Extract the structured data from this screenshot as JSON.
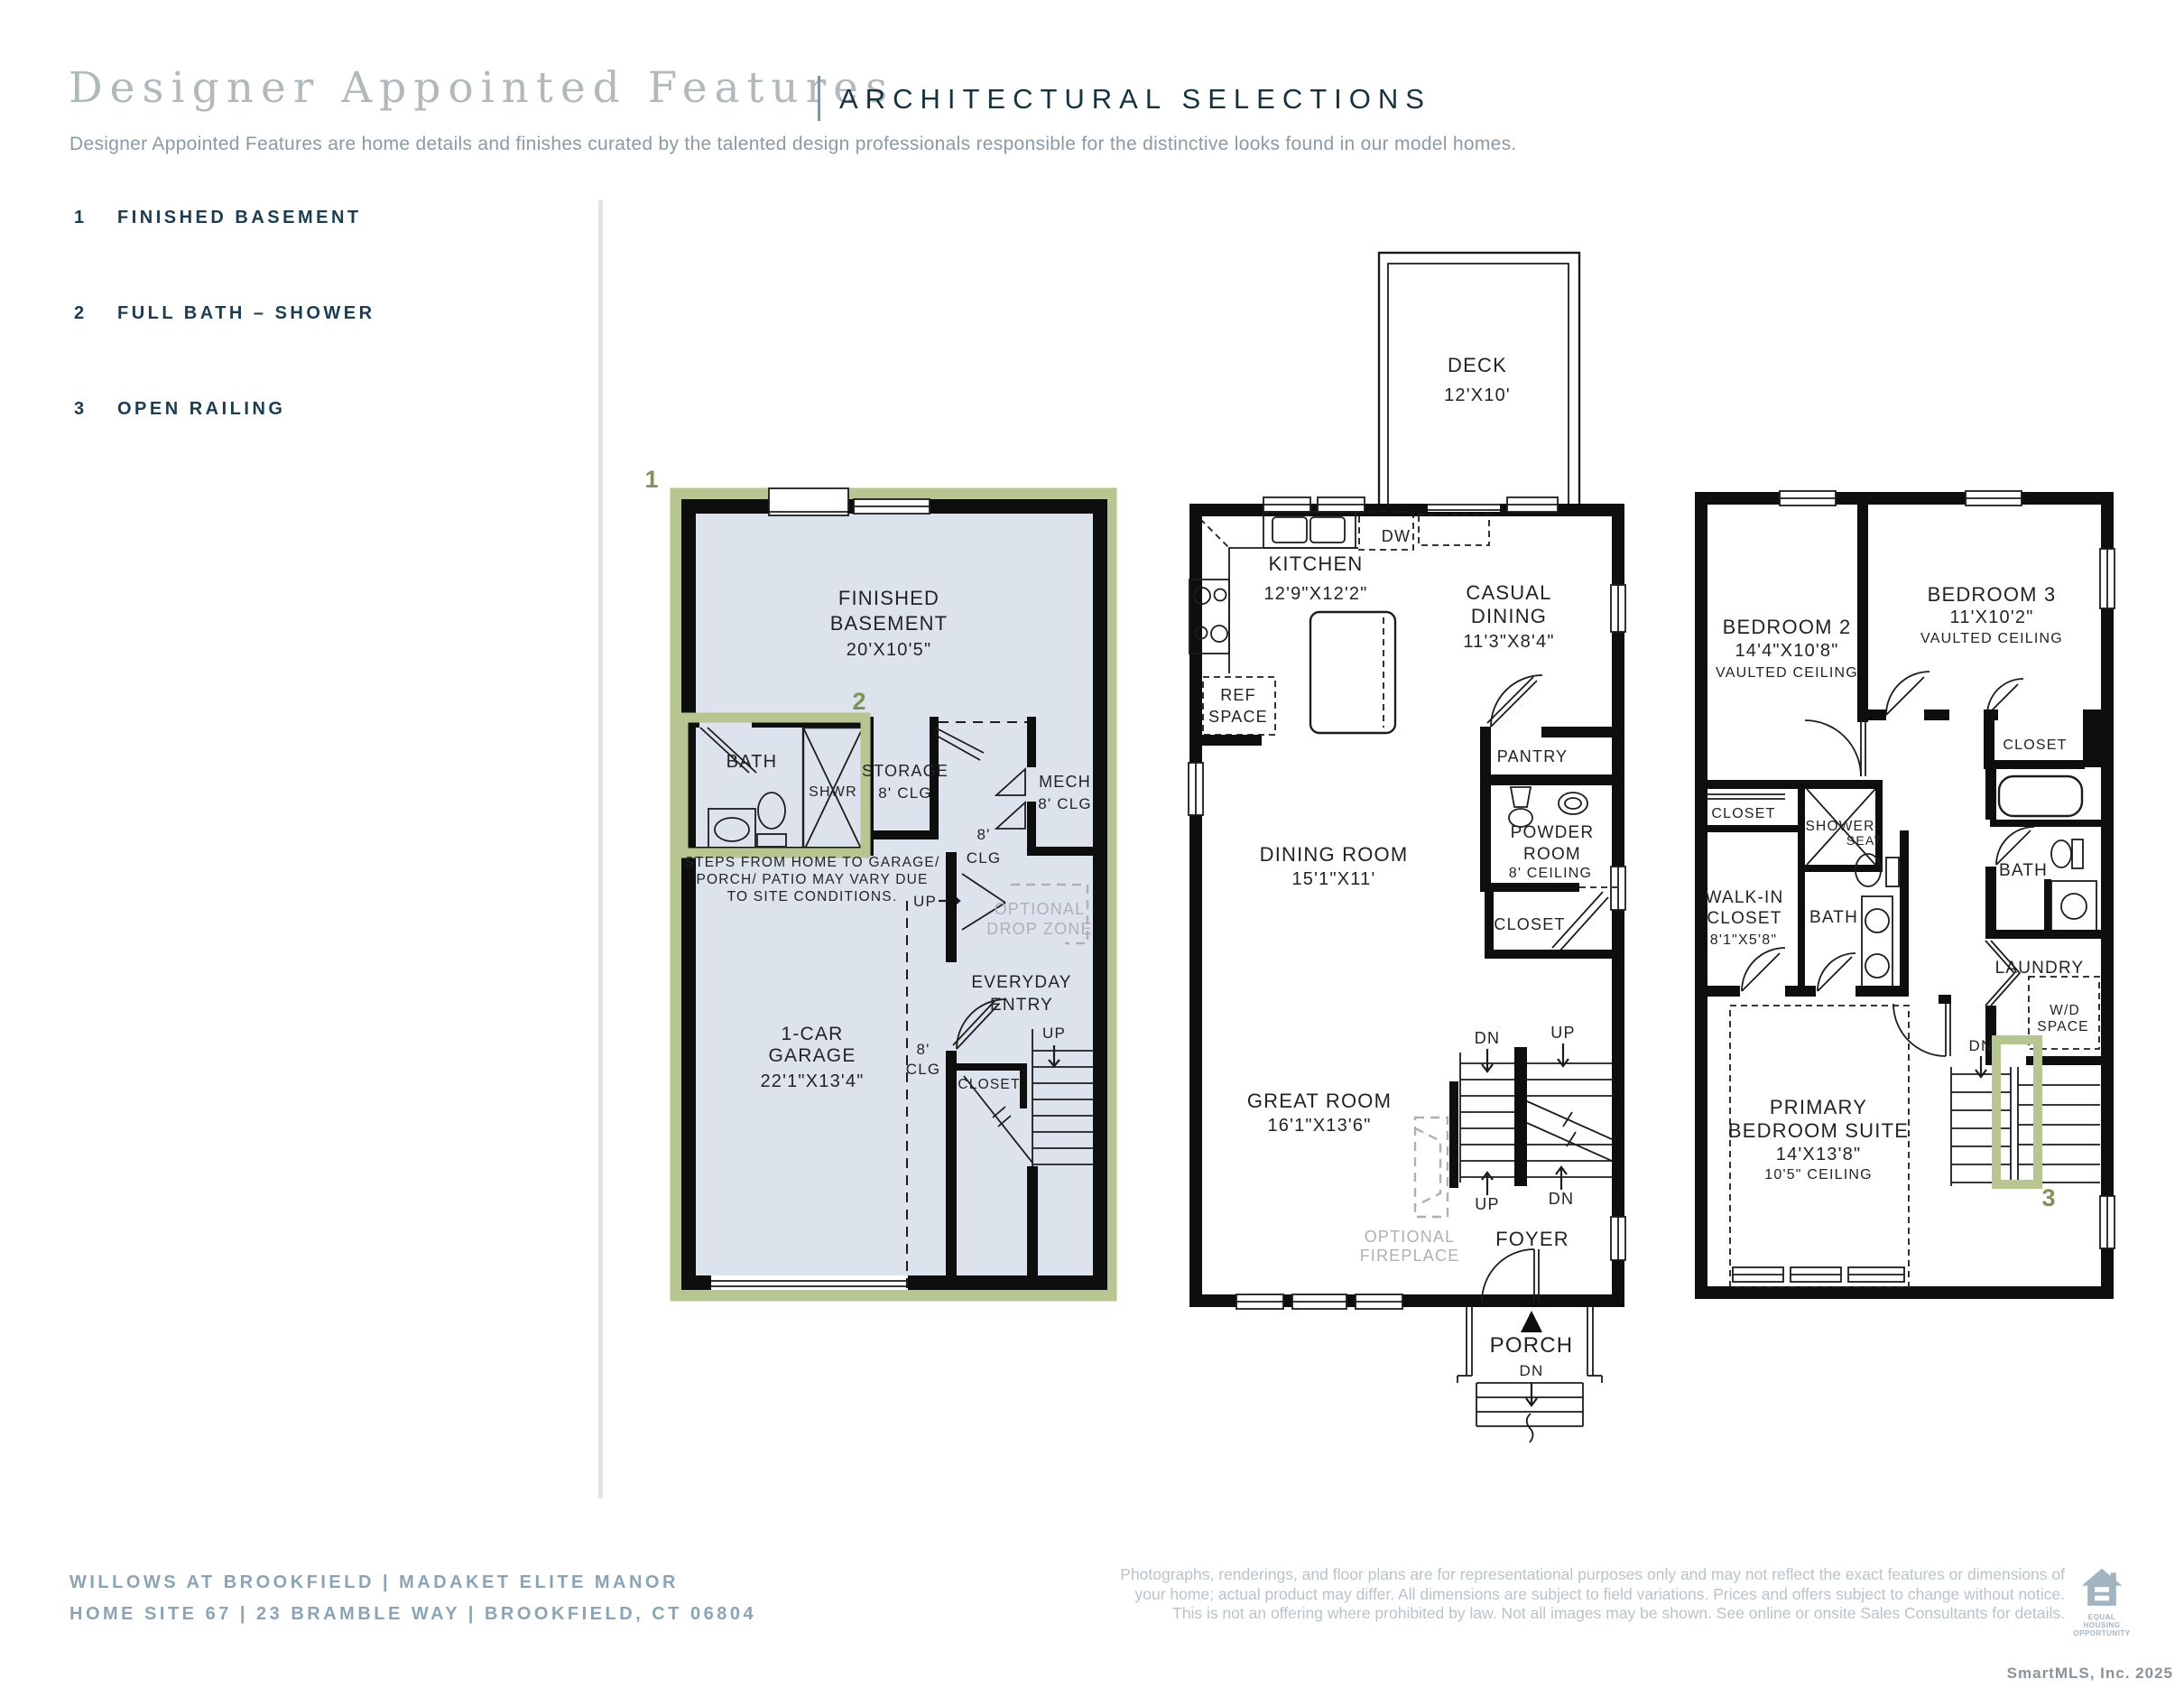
{
  "header": {
    "title": "Designer Appointed Features",
    "section": "ARCHITECTURAL SELECTIONS",
    "subtitle": "Designer Appointed Features are home details and finishes curated by the talented design professionals responsible for the distinctive looks found in our model homes."
  },
  "features": [
    {
      "num": "1",
      "label": "FINISHED BASEMENT"
    },
    {
      "num": "2",
      "label": "FULL BATH – SHOWER"
    },
    {
      "num": "3",
      "label": "OPEN RAILING"
    }
  ],
  "plans": {
    "basement": {
      "badge": "1",
      "bath_badge": "2",
      "finished_basement": [
        "FINISHED",
        "BASEMENT",
        "20'X10'5\""
      ],
      "bath": "BATH",
      "shwr": "SHWR",
      "storage": [
        "STORAGE",
        "8' CLG"
      ],
      "mech": [
        "MECH",
        "8' CLG"
      ],
      "hall_clg": [
        "8'",
        "CLG"
      ],
      "steps_note": [
        "STEPS FROM HOME TO GARAGE/",
        "PORCH/ PATIO MAY VARY DUE",
        "TO SITE CONDITIONS."
      ],
      "up1": "UP",
      "optional_drop_zone": [
        "OPTIONAL",
        "DROP ZONE"
      ],
      "everyday_entry": [
        "EVERYDAY",
        "ENTRY"
      ],
      "garage": [
        "1-CAR",
        "GARAGE",
        "22'1\"X13'4\""
      ],
      "garage_clg": [
        "8'",
        "CLG"
      ],
      "closet": "CLOSET",
      "up2": "UP"
    },
    "first": {
      "deck": [
        "DECK",
        "12'X10'"
      ],
      "kitchen": [
        "KITCHEN",
        "12'9\"X12'2\""
      ],
      "dw": "DW",
      "ref_space": [
        "REF",
        "SPACE"
      ],
      "casual_dining": [
        "CASUAL",
        "DINING",
        "11'3\"X8'4\""
      ],
      "pantry": "PANTRY",
      "powder_room": [
        "POWDER",
        "ROOM",
        "8' CEILING"
      ],
      "dining_room": [
        "DINING ROOM",
        "15'1\"X11'"
      ],
      "closet": "CLOSET",
      "great_room": [
        "GREAT ROOM",
        "16'1\"X13'6\""
      ],
      "dn_top": "DN",
      "up_top": "UP",
      "up_bottom": "UP",
      "dn_bottom": "DN",
      "optional_fireplace": [
        "OPTIONAL",
        "FIREPLACE"
      ],
      "foyer": "FOYER",
      "porch": "PORCH",
      "porch_dn": "DN"
    },
    "second": {
      "badge": "3",
      "bedroom2": [
        "BEDROOM 2",
        "14'4\"X10'8\"",
        "VAULTED CEILING"
      ],
      "bedroom3": [
        "BEDROOM 3",
        "11'X10'2\"",
        "VAULTED CEILING"
      ],
      "closet_b3": "CLOSET",
      "closet_left": "CLOSET",
      "shower": "SHOWER",
      "seat": "SEAT",
      "walk_in_closet": [
        "WALK-IN",
        "CLOSET",
        "8'1\"X5'8\""
      ],
      "bath_center": "BATH",
      "bath_right": "BATH",
      "laundry": "LAUNDRY",
      "wd_space": [
        "W/D",
        "SPACE"
      ],
      "dn": "DN",
      "primary": [
        "PRIMARY",
        "BEDROOM SUITE",
        "14'X13'8\"",
        "10'5\" CEILING"
      ]
    }
  },
  "footer": {
    "community": "WILLOWS AT BROOKFIELD  |  MADAKET ELITE MANOR",
    "address": "HOME SITE 67  |  23 BRAMBLE WAY  |  BROOKFIELD, CT 06804",
    "disclaimer": [
      "Photographs, renderings, and floor plans are for representational purposes only and may not reflect the exact features or dimensions of",
      "your home; actual product may differ. All dimensions are subject to field variations. Prices and offers subject to change without notice.",
      "This is not an offering where prohibited by law. Not all images may be shown. See online or onsite Sales Consultants for details."
    ],
    "eho": [
      "EQUAL HOUSING",
      "OPPORTUNITY"
    ],
    "credit": "SmartMLS, Inc.  2025"
  },
  "colors": {
    "highlight_green": "#b7c590",
    "highlight_green_dark": "#7e9355",
    "navy": "#16323f",
    "steel_blue": "#8ba4b5",
    "plan_fill_blue": "#dce3ed"
  }
}
